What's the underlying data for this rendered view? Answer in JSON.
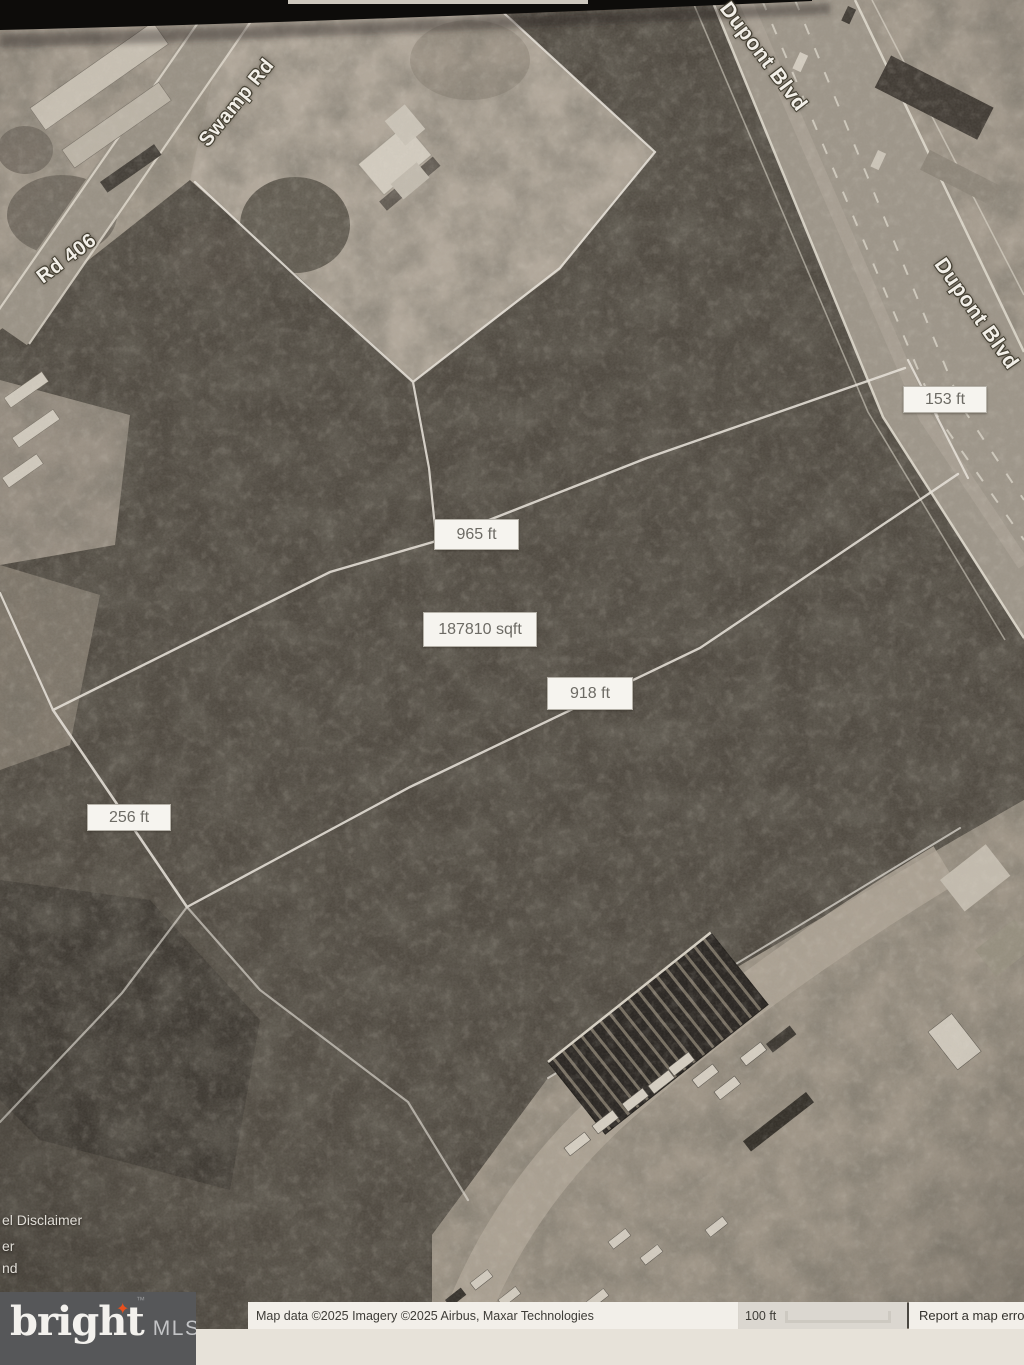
{
  "map": {
    "road_labels": {
      "swamp_rd": "Swamp Rd",
      "rd_406": "Rd 406",
      "dupont_blvd_top": "Dupont Blvd",
      "dupont_blvd_right": "Dupont Blvd"
    },
    "measurements": {
      "m153": "153 ft",
      "m965": "965 ft",
      "area": "187810 sqft",
      "m918": "918 ft",
      "m256": "256 ft"
    },
    "partial_ui_text": {
      "line1": "el Disclaimer",
      "line2": "er",
      "line3": "nd"
    }
  },
  "attribution": {
    "map_data": "Map data ©2025 Imagery ©2025 Airbus, Maxar Technologies",
    "scale_label": "100 ft",
    "report_error": "Report a map erro"
  },
  "logo": {
    "brand": "bright",
    "star_glyph": "✦",
    "trademark": "™",
    "suffix": "MLS"
  },
  "colors": {
    "logo_star": "#e8501e",
    "logo_bg": "#565759",
    "paper": "#e7e2d9",
    "label_box_bg": "#f6f4ef",
    "parcel_line": "#efebe2"
  }
}
